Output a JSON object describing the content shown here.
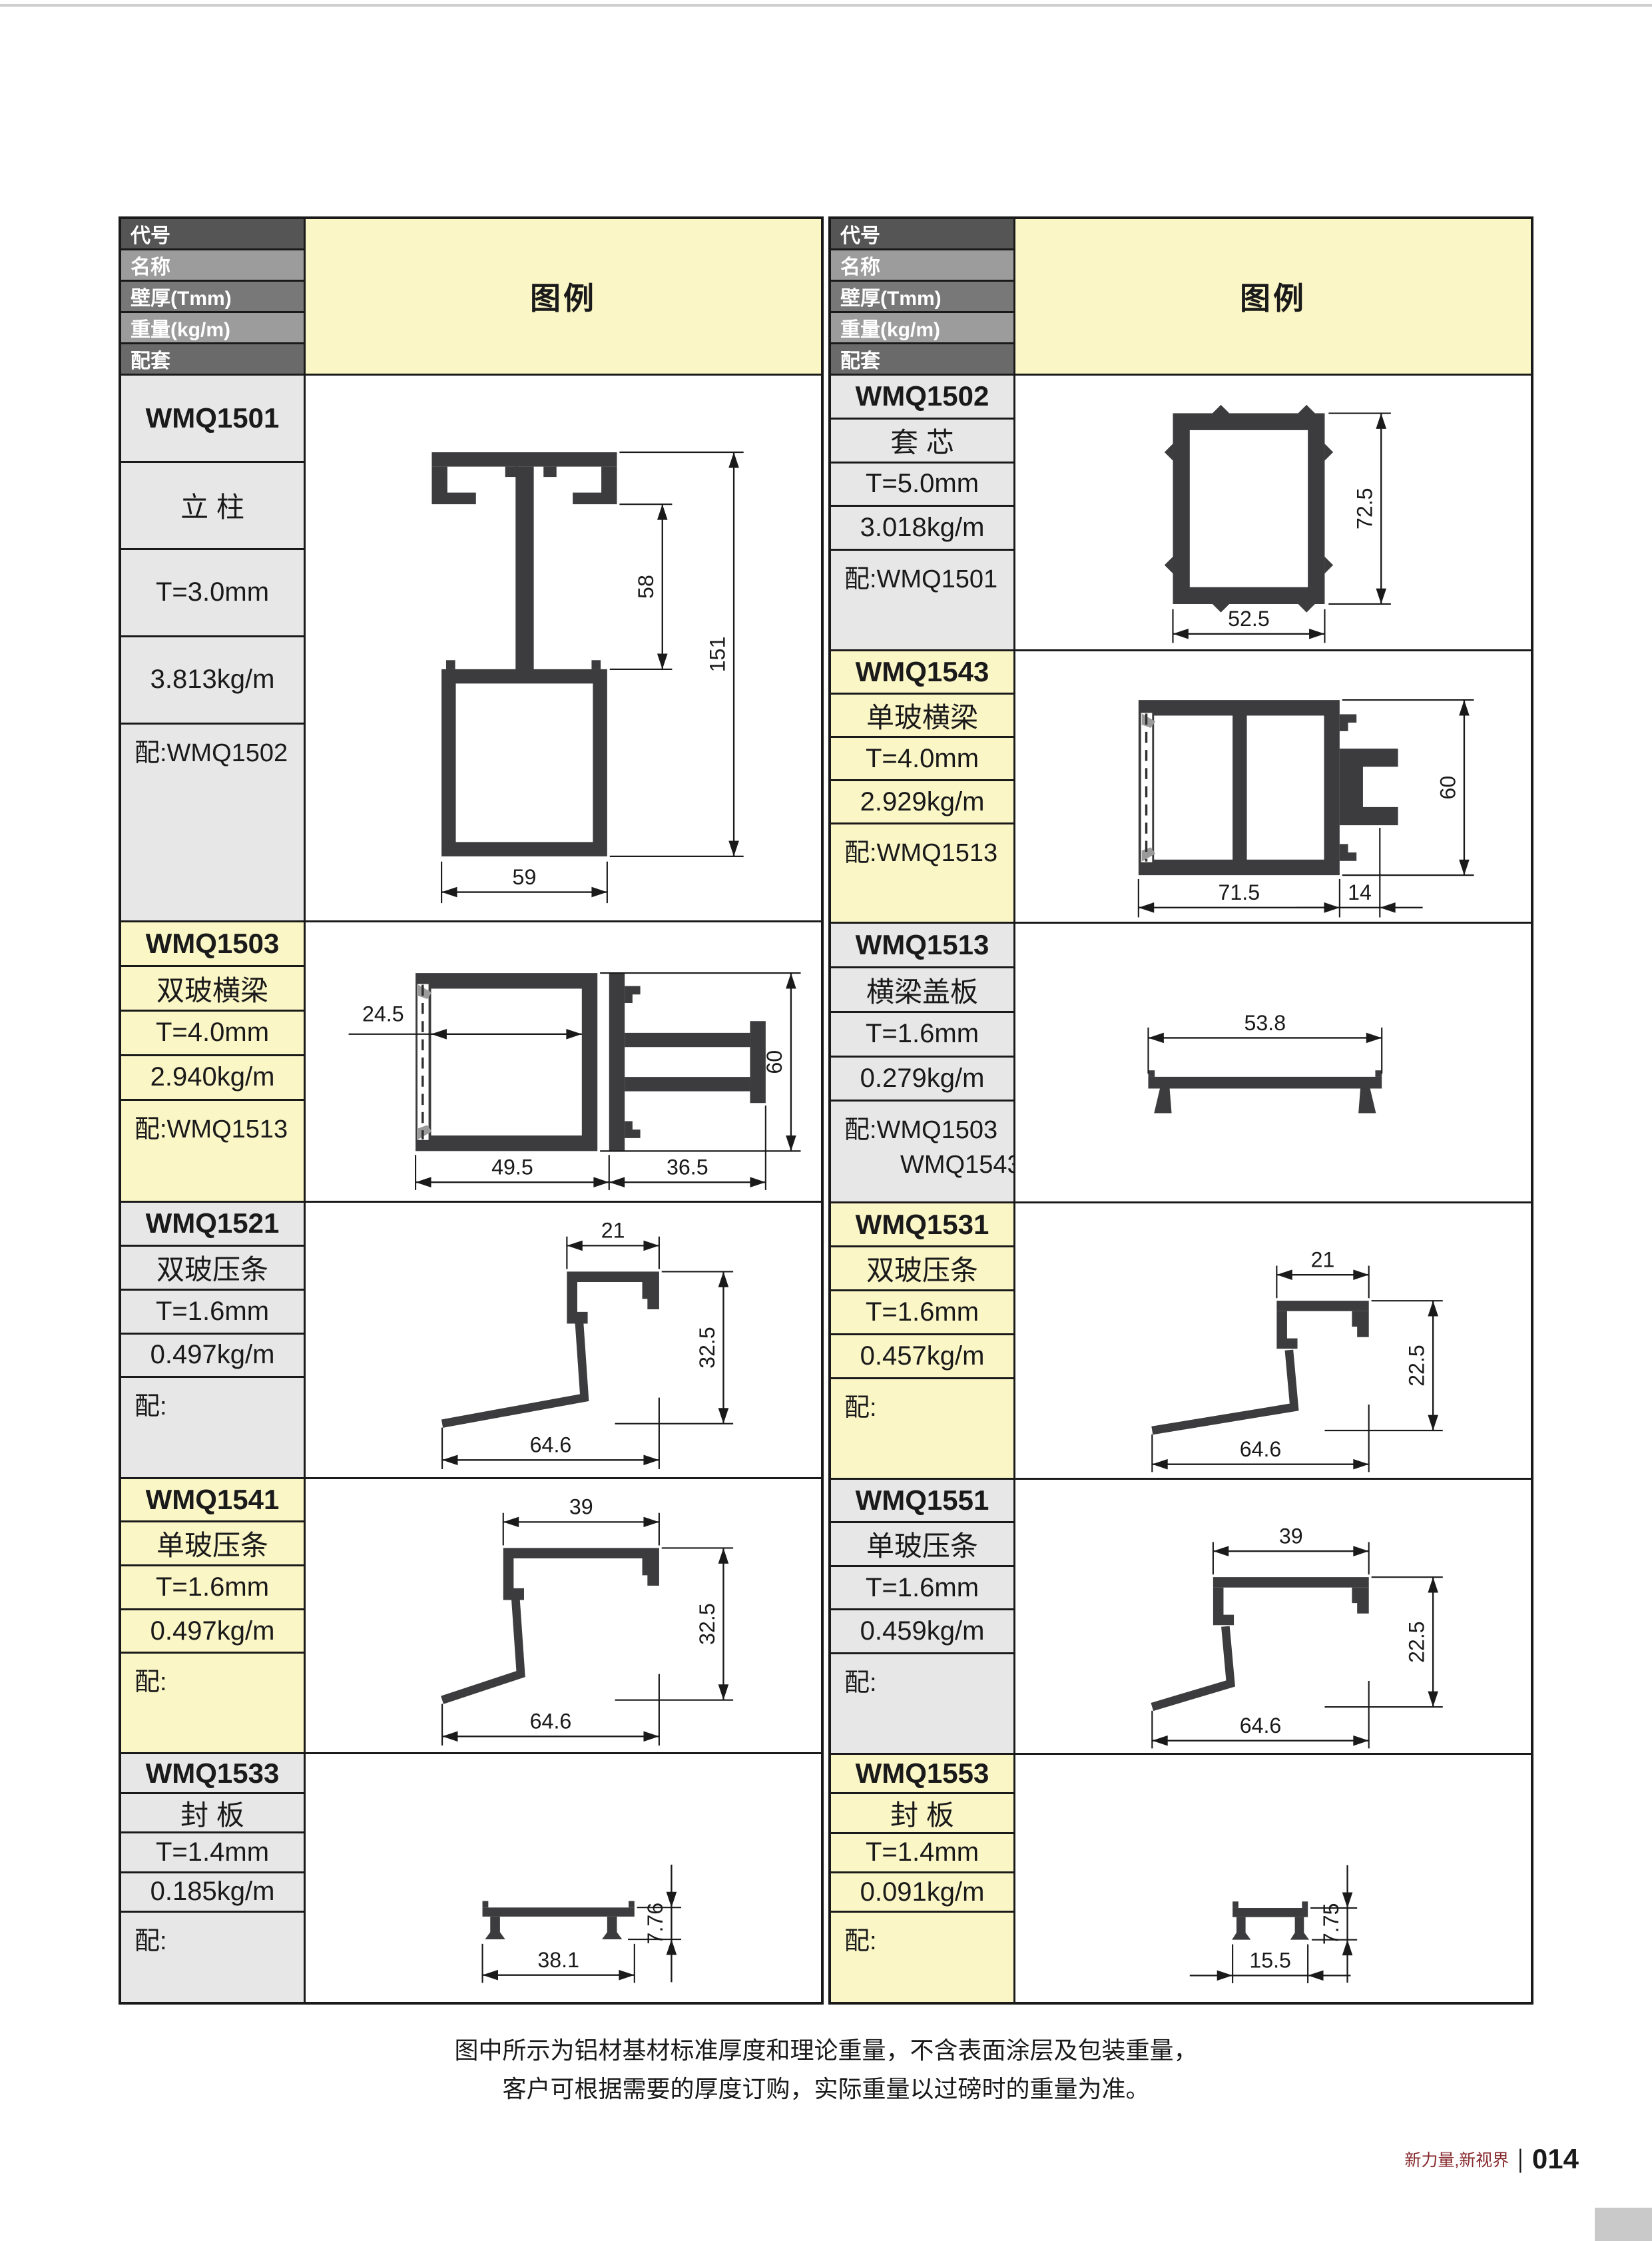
{
  "header": {
    "rows": [
      "代号",
      "名称",
      "壁厚(Tmm)",
      "重量(kg/m)",
      "配套"
    ],
    "legend_label": "图例"
  },
  "colors": {
    "accent_yellow": "#fbf6c6",
    "cell_gray": "#e7e7e7",
    "header_grays": [
      "#555555",
      "#9c9c9c",
      "#787878",
      "#9c9c9c",
      "#6a6a6a"
    ],
    "profile_fill": "#3c3c3e",
    "border": "#1a1a1a",
    "footer_brand_color": "#86272b"
  },
  "tables": [
    {
      "blocks": [
        {
          "code": "WMQ1501",
          "name": "立 柱",
          "thickness": "T=3.0mm",
          "weight": "3.813kg/m",
          "match": "配:WMQ1502",
          "match_extra": "",
          "tone": "gray",
          "dims": [
            "58",
            "151",
            "59"
          ]
        },
        {
          "code": "WMQ1503",
          "name": "双玻横梁",
          "thickness": "T=4.0mm",
          "weight": "2.940kg/m",
          "match": "配:WMQ1513",
          "match_extra": "",
          "tone": "yellow",
          "dims": [
            "24.5",
            "60",
            "49.5",
            "36.5"
          ]
        },
        {
          "code": "WMQ1521",
          "name": "双玻压条",
          "thickness": "T=1.6mm",
          "weight": "0.497kg/m",
          "match": "配:",
          "match_extra": "",
          "tone": "gray",
          "dims": [
            "21",
            "32.5",
            "64.6"
          ]
        },
        {
          "code": "WMQ1541",
          "name": "单玻压条",
          "thickness": "T=1.6mm",
          "weight": "0.497kg/m",
          "match": "配:",
          "match_extra": "",
          "tone": "yellow",
          "dims": [
            "39",
            "32.5",
            "64.6"
          ]
        },
        {
          "code": "WMQ1533",
          "name": "封 板",
          "thickness": "T=1.4mm",
          "weight": "0.185kg/m",
          "match": "配:",
          "match_extra": "",
          "tone": "gray",
          "dims": [
            "7.76",
            "38.1"
          ]
        }
      ]
    },
    {
      "blocks": [
        {
          "code": "WMQ1502",
          "name": "套 芯",
          "thickness": "T=5.0mm",
          "weight": "3.018kg/m",
          "match": "配:WMQ1501",
          "match_extra": "",
          "tone": "gray",
          "dims": [
            "72.5",
            "52.5"
          ]
        },
        {
          "code": "WMQ1543",
          "name": "单玻横梁",
          "thickness": "T=4.0mm",
          "weight": "2.929kg/m",
          "match": "配:WMQ1513",
          "match_extra": "",
          "tone": "yellow",
          "dims": [
            "60",
            "71.5",
            "14"
          ]
        },
        {
          "code": "WMQ1513",
          "name": "横梁盖板",
          "thickness": "T=1.6mm",
          "weight": "0.279kg/m",
          "match": "配:WMQ1503",
          "match_extra": "WMQ1543",
          "tone": "gray",
          "dims": [
            "53.8"
          ]
        },
        {
          "code": "WMQ1531",
          "name": "双玻压条",
          "thickness": "T=1.6mm",
          "weight": "0.457kg/m",
          "match": "配:",
          "match_extra": "",
          "tone": "yellow",
          "dims": [
            "21",
            "22.5",
            "64.6"
          ]
        },
        {
          "code": "WMQ1551",
          "name": "单玻压条",
          "thickness": "T=1.6mm",
          "weight": "0.459kg/m",
          "match": "配:",
          "match_extra": "",
          "tone": "gray",
          "dims": [
            "39",
            "22.5",
            "64.6"
          ]
        },
        {
          "code": "WMQ1553",
          "name": "封 板",
          "thickness": "T=1.4mm",
          "weight": "0.091kg/m",
          "match": "配:",
          "match_extra": "",
          "tone": "yellow",
          "dims": [
            "7.75",
            "15.5"
          ]
        }
      ]
    }
  ],
  "footnote": {
    "line1": "图中所示为铝材基材标准厚度和理论重量，不含表面涂层及包装重量，",
    "line2": "客户可根据需要的厚度订购，实际重量以过磅时的重量为准。"
  },
  "footer": {
    "brand": "新力量,新视界",
    "divider": "|",
    "page": "014"
  }
}
